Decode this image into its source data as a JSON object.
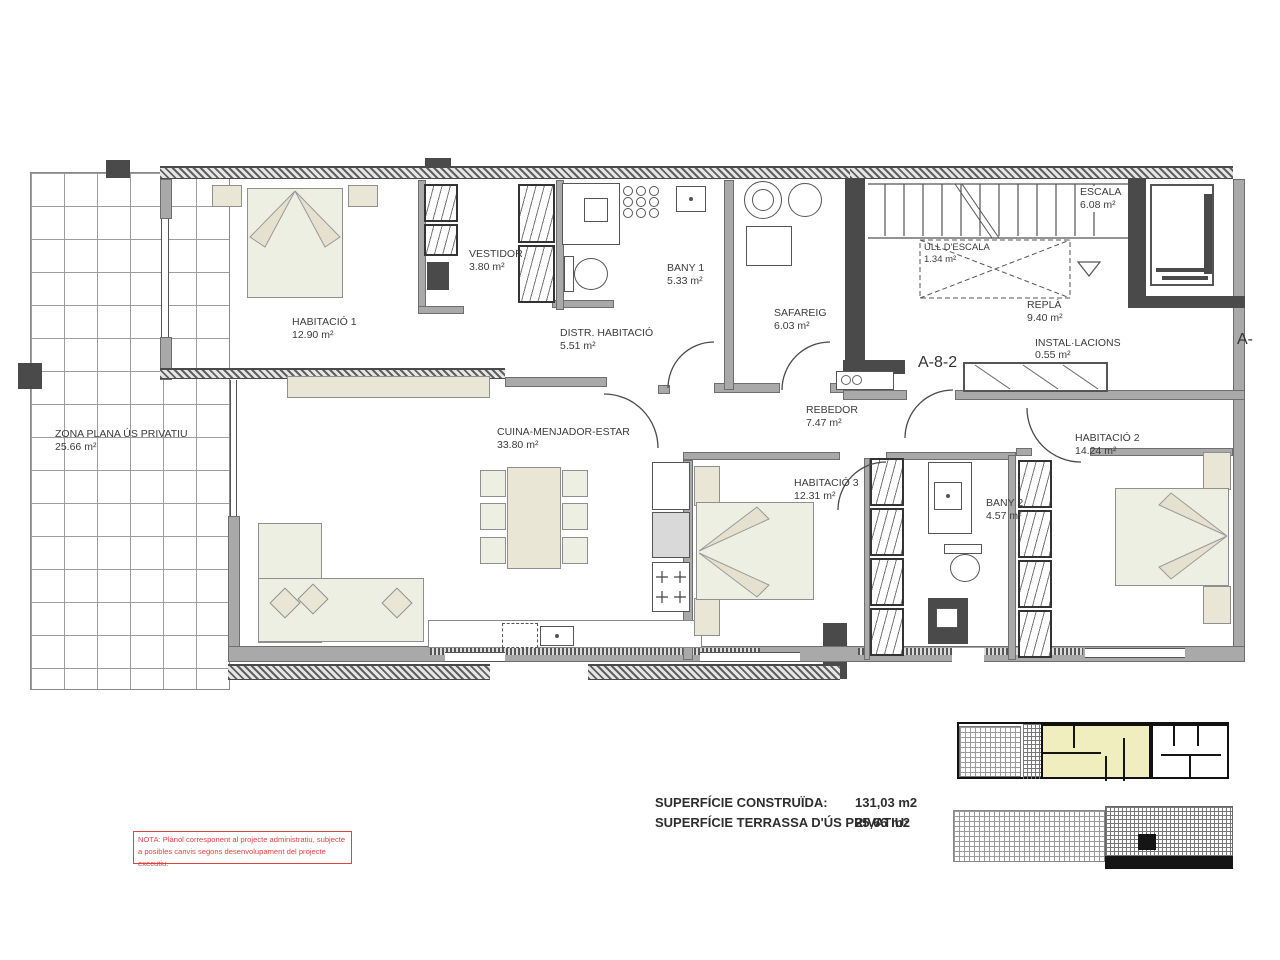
{
  "plan": {
    "rooms": [
      {
        "name": "HABITACIÓ 1",
        "area": "12.90 m²"
      },
      {
        "name": "VESTIDOR",
        "area": "3.80 m²"
      },
      {
        "name": "BANY 1",
        "area": "5.33 m²"
      },
      {
        "name": "DISTR. HABITACIÓ",
        "area": "5.51 m²"
      },
      {
        "name": "SAFAREIG",
        "area": "6.03 m²"
      },
      {
        "name": "ESCALA",
        "area": "6.08 m²"
      },
      {
        "name": "ULL D'ESCALA",
        "area": "1.34 m²"
      },
      {
        "name": "REPLÀ",
        "area": "9.40 m²"
      },
      {
        "name": "INSTAL·LACIONS",
        "area": "0.55 m²"
      },
      {
        "name": "REBEDOR",
        "area": "7.47 m²"
      },
      {
        "name": "CUINA-MENJADOR-ESTAR",
        "area": "33.80 m²"
      },
      {
        "name": "HABITACIÓ 3",
        "area": "12.31 m²"
      },
      {
        "name": "BANY 2",
        "area": "4.57 m²"
      },
      {
        "name": "HABITACIÓ 2",
        "area": "14.24 m²"
      },
      {
        "name": "ZONA PLANA ÚS PRIVATIU",
        "area": "25.66 m²"
      }
    ],
    "markers": {
      "detail": "A-8-2",
      "edge": "A-"
    },
    "summary": {
      "construida_label": "SUPERFÍCIE CONSTRUÏDA:",
      "construida_value": "131,03 m2",
      "terrassa_label": "SUPERFÍCIE TERRASSA D'ÚS PRIVATIU:",
      "terrassa_value": "25,66 m2"
    },
    "note": {
      "line1": "NOTA: Plànol corresponent al projecte administratiu, subjecte",
      "line2": "a posibles canvis segons desenvolupament del projecte executiu."
    },
    "colors": {
      "wall_gray": "#a9a9a9",
      "structure_dark": "#4a4a4a",
      "furniture_beige": "#eae6d5",
      "bed_pale": "#edefe3",
      "note_red": "#e04341",
      "keyplan_yellow": "#f0edbf"
    }
  }
}
